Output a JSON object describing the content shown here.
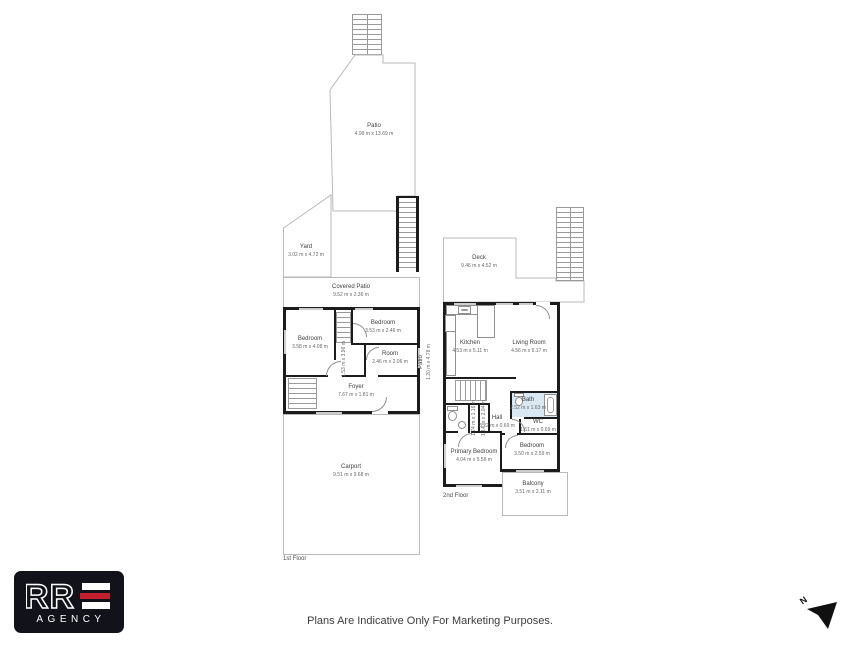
{
  "disclaimer": "Plans Are Indicative Only For Marketing Purposes.",
  "logo": {
    "brand": "RRE",
    "brand_outline": "RR",
    "subtitle": "AGENCY",
    "bg_color": "#12121b",
    "accent_color": "#c41e2f"
  },
  "compass": {
    "north": "N"
  },
  "floor1": {
    "name": "1st Floor",
    "rooms": {
      "patio": {
        "name": "Patio",
        "dims": "4.99 m x 13.69 m"
      },
      "yard": {
        "name": "Yard",
        "dims": "3.02 m x 4.72 m"
      },
      "covered_patio": {
        "name": "Covered Patio",
        "dims": "9.52 m x 2.36 m"
      },
      "bedroom_left": {
        "name": "Bedroom",
        "dims": "3.58 m x 4.08 m"
      },
      "bedroom_top": {
        "name": "Bedroom",
        "dims": "3.53 m x 2.46 m"
      },
      "room": {
        "name": "Room",
        "dims": "2.46 m x 2.06 m"
      },
      "foyer": {
        "name": "Foyer",
        "dims": "7.67 m x 1.81 m"
      },
      "hall": {
        "dims": "1.53 m x 3.96 m"
      },
      "side_patio": {
        "name": "Patio",
        "dims": "1.20 m x 4.78 m"
      },
      "carport": {
        "name": "Carport",
        "dims": "9.51 m x 9.68 m"
      }
    }
  },
  "floor2": {
    "name": "2nd Floor",
    "rooms": {
      "deck": {
        "name": "Deck",
        "dims": "9.46 m x 4.52 m"
      },
      "kitchen": {
        "name": "Kitchen",
        "dims": "4.53 m x 5.11 m"
      },
      "living_room": {
        "name": "Living Room",
        "dims": "4.56 m x 6.17 m"
      },
      "bath": {
        "name": "Bath",
        "dims": "2.52 m x 1.63 m"
      },
      "hall": {
        "name": "Hall",
        "dims": "3.22 m x 0.69 m"
      },
      "wc": {
        "name": "WC",
        "dims": "1.61 m x 0.69 m"
      },
      "wc_small": {
        "dims": "1.74 m x 1.16 m"
      },
      "closet": {
        "dims": "1.14 m x 2.04 m"
      },
      "primary_bedroom": {
        "name": "Primary Bedroom",
        "dims": "4.04 m x 5.56 m"
      },
      "bedroom": {
        "name": "Bedroom",
        "dims": "3.50 m x 2.59 m"
      },
      "balcony": {
        "name": "Balcony",
        "dims": "3.51 m x 2.11 m"
      }
    }
  }
}
